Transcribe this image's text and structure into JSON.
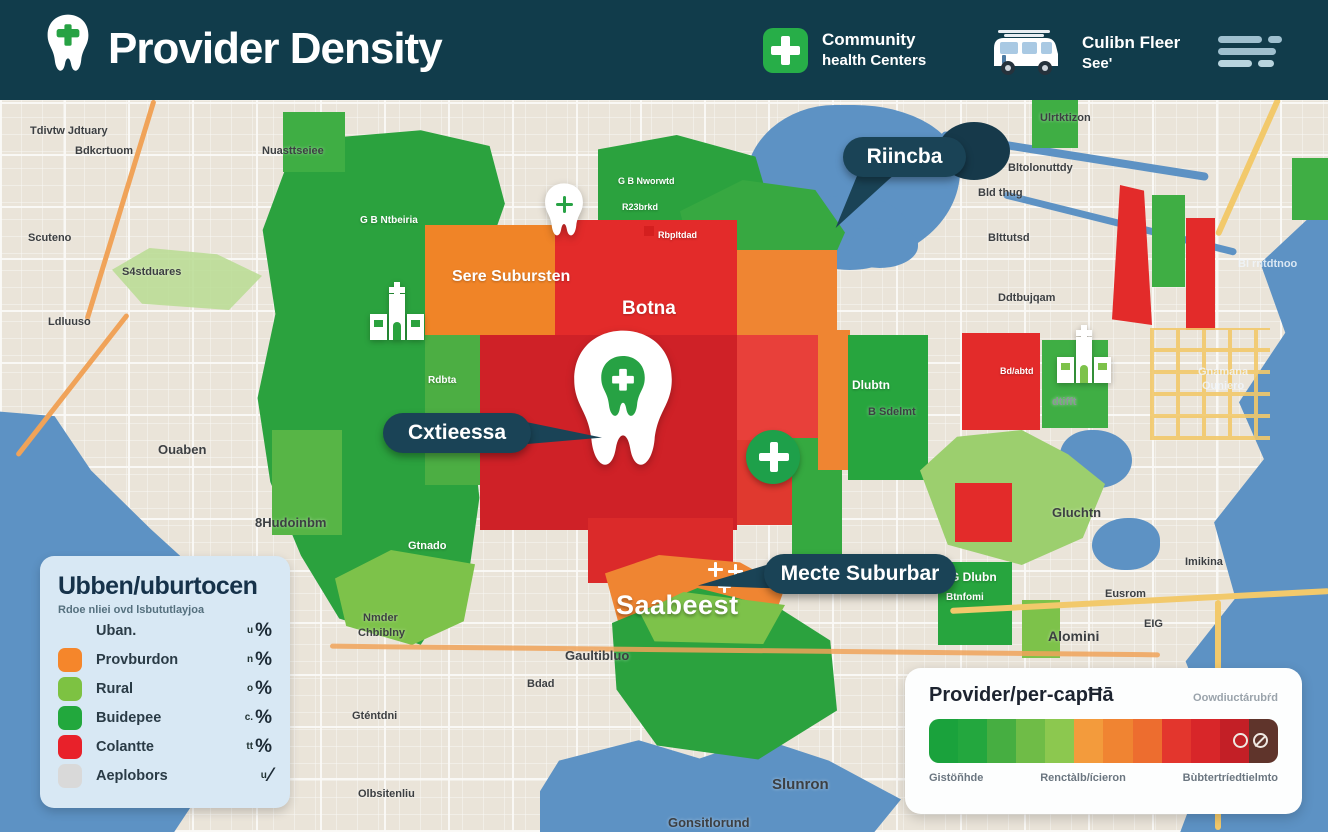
{
  "colors": {
    "header_bg": "#113c4b",
    "callout_bg": "#1a4356",
    "water": "#5d92c4",
    "land": "#eae4d9",
    "green_dark": "#27a53e",
    "green_light": "#7dc24a",
    "orange": "#f08427",
    "red": "#e32b2a",
    "crimson": "#cf2127",
    "maroon": "#5f342b",
    "legend_card": "#d8e8f4"
  },
  "icons": {
    "logo": "tooth-icon",
    "community": "cross-square-icon",
    "fleet": "van-icon",
    "menu": "lines-menu-icon",
    "map_icons": [
      "tooth-marker-icon",
      "clinic-building-icon",
      "cross-circle-icon",
      "mini-cross-cluster-icon"
    ]
  },
  "header": {
    "title": "Provider Density",
    "badge1": {
      "line1": "Community",
      "line2": "health Centers"
    },
    "badge2": {
      "line1": "Culibn Fleer",
      "line2": "See'"
    }
  },
  "callouts": [
    {
      "label": "Riincba"
    },
    {
      "label": "Cxtieessa"
    },
    {
      "label": "Mecte Suburbar"
    }
  ],
  "legend": {
    "title": "Ubben/uburtocen",
    "subtitle": "Rdoe nliei ovd lsbututlayjoa",
    "rows": [
      {
        "swatch": "none",
        "label": "Uban.",
        "prefix": "u",
        "unit": "%"
      },
      {
        "swatch": "#f5862b",
        "label": "Provburdon",
        "prefix": "n",
        "unit": "%"
      },
      {
        "swatch": "#7dc242",
        "label": "Rural",
        "prefix": "o",
        "unit": "%"
      },
      {
        "swatch": "#22a83d",
        "label": "Buidepee",
        "prefix": "c.",
        "unit": "%"
      },
      {
        "swatch": "#e8212a",
        "label": "Colantte",
        "prefix": "tt",
        "unit": "%"
      },
      {
        "swatch": "#d9d9d9",
        "label": "Aeplobors",
        "prefix": "u",
        "unit": "⁄"
      }
    ]
  },
  "percap": {
    "title": "Provider/per-capĦā",
    "note": "Oowdiuctárubŕd",
    "gradient": [
      "#1aa23c",
      "#23a73e",
      "#46ae41",
      "#6fbc47",
      "#8cc84f",
      "#f39b3c",
      "#f08432",
      "#ed6d2f",
      "#e3362d",
      "#d82629",
      "#c31f26",
      "#5f342b"
    ],
    "labels": [
      "Gistöñhde",
      "Renctàlb/ícieron",
      "Bùbtertríedtielmto"
    ]
  },
  "map": {
    "labels": [
      {
        "text": "Tdivtw Jdtuary",
        "x": 30,
        "y": 25,
        "cls": "d"
      },
      {
        "text": "Bdkcrtuom",
        "x": 75,
        "y": 45,
        "cls": "d"
      },
      {
        "text": "Nuasttseiee",
        "x": 262,
        "y": 45,
        "cls": "d"
      },
      {
        "text": "Scuteno",
        "x": 28,
        "y": 132,
        "cls": "d"
      },
      {
        "text": "S4stduares",
        "x": 122,
        "y": 166,
        "cls": "d"
      },
      {
        "text": "Ldluuso",
        "x": 48,
        "y": 216,
        "cls": "d"
      },
      {
        "text": "Ouaben",
        "x": 158,
        "y": 342,
        "cls": "d",
        "size": 13
      },
      {
        "text": "8Hudoinbm",
        "x": 255,
        "y": 415,
        "cls": "d",
        "size": 13
      },
      {
        "text": "Nmder",
        "x": 363,
        "y": 512,
        "cls": "d"
      },
      {
        "text": "Chbiblny",
        "x": 358,
        "y": 527,
        "cls": "d"
      },
      {
        "text": "Gaultibluo",
        "x": 565,
        "y": 548,
        "cls": "d",
        "size": 13
      },
      {
        "text": "Bdad",
        "x": 527,
        "y": 578,
        "cls": "d"
      },
      {
        "text": "Gténtdni",
        "x": 352,
        "y": 610,
        "cls": "d"
      },
      {
        "text": "Olbsitenliu",
        "x": 358,
        "y": 688,
        "cls": "d"
      },
      {
        "text": "Slunron",
        "x": 772,
        "y": 676,
        "cls": "d",
        "size": 15
      },
      {
        "text": "Gonsitlorund",
        "x": 668,
        "y": 715,
        "cls": "d",
        "size": 13
      },
      {
        "text": "Ulrtktizon",
        "x": 1040,
        "y": 12,
        "cls": "d"
      },
      {
        "text": "Bltolonuttdy",
        "x": 1008,
        "y": 62,
        "cls": "d"
      },
      {
        "text": "Bld thug",
        "x": 978,
        "y": 87,
        "cls": "d"
      },
      {
        "text": "Blttutsd",
        "x": 988,
        "y": 132,
        "cls": "d"
      },
      {
        "text": "Ddtbujqam",
        "x": 998,
        "y": 192,
        "cls": "d"
      },
      {
        "text": "Gluchtn",
        "x": 1052,
        "y": 405,
        "cls": "d",
        "size": 13
      },
      {
        "text": "Eusrom",
        "x": 1105,
        "y": 488,
        "cls": "d"
      },
      {
        "text": "Alomini",
        "x": 1048,
        "y": 528,
        "cls": "d",
        "size": 14
      },
      {
        "text": "EIG",
        "x": 1144,
        "y": 518,
        "cls": "d"
      },
      {
        "text": "Imikina",
        "x": 1185,
        "y": 456,
        "cls": "d"
      },
      {
        "text": "dtifft",
        "x": 1052,
        "y": 296,
        "cls": "g"
      },
      {
        "text": "Bl rntdtnoo",
        "x": 1238,
        "y": 158,
        "cls": "w"
      },
      {
        "text": "Gnamana",
        "x": 1198,
        "y": 266,
        "cls": "w"
      },
      {
        "text": "Ouniero",
        "x": 1202,
        "y": 280,
        "cls": "w"
      },
      {
        "text": "Sere Subursten",
        "x": 452,
        "y": 168,
        "cls": "wt",
        "size": 16
      },
      {
        "text": "Botna",
        "x": 622,
        "y": 198,
        "cls": "wt",
        "size": 19
      },
      {
        "text": "Saabeest",
        "x": 616,
        "y": 490,
        "cls": "wt big",
        "size": 27
      },
      {
        "text": "Rdbta",
        "x": 428,
        "y": 275,
        "cls": "wt",
        "size": 10
      },
      {
        "text": "Gtnado",
        "x": 408,
        "y": 440,
        "cls": "wt",
        "size": 11
      },
      {
        "text": "Dlubtn",
        "x": 852,
        "y": 278,
        "cls": "wt",
        "size": 12
      },
      {
        "text": "B Sdelmt",
        "x": 868,
        "y": 306,
        "cls": "d"
      },
      {
        "text": "Bd/abtd",
        "x": 1000,
        "y": 266,
        "cls": "wt",
        "size": 9
      },
      {
        "text": "G Dlubn",
        "x": 950,
        "y": 470,
        "cls": "wt",
        "size": 12
      },
      {
        "text": "Btnfomi",
        "x": 946,
        "y": 492,
        "cls": "wt",
        "size": 10
      },
      {
        "text": "G B Ntbeiria",
        "x": 360,
        "y": 115,
        "cls": "wt",
        "size": 10
      },
      {
        "text": "G B Nworwtd",
        "x": 618,
        "y": 76,
        "cls": "wt",
        "size": 9
      },
      {
        "text": "R23brkd",
        "x": 622,
        "y": 102,
        "cls": "wt",
        "size": 9
      },
      {
        "text": "Rbpltdad",
        "x": 658,
        "y": 130,
        "cls": "wt",
        "size": 9
      }
    ]
  }
}
